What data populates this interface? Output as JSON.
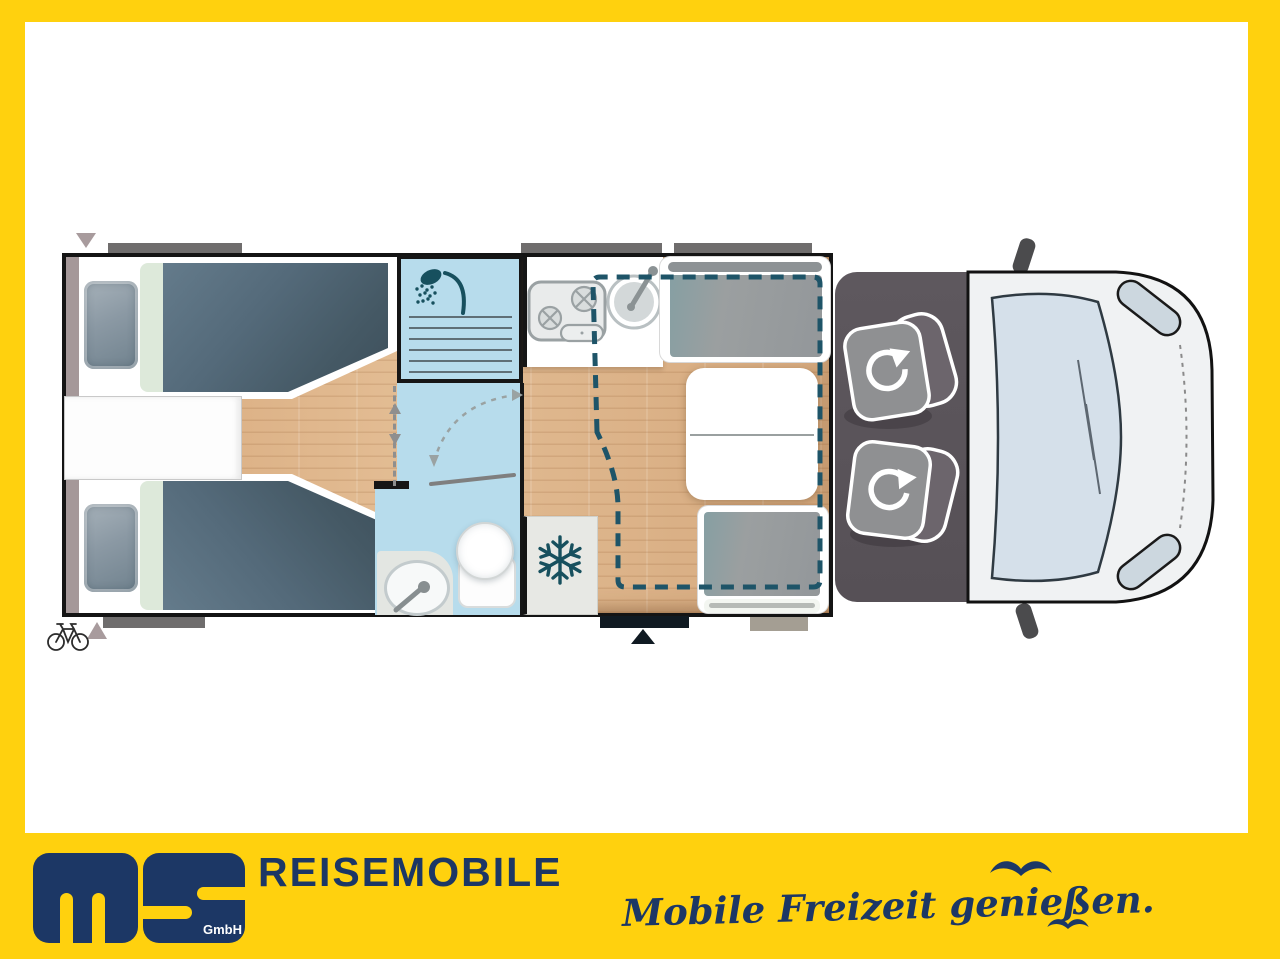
{
  "branding": {
    "logo_text": "ms",
    "logo_suffix": "GmbH",
    "wordmark": "REISEMOBILE",
    "tagline": "Mobile Freizeit genießen."
  },
  "colors": {
    "frame_yellow": "#FFD10E",
    "brand_navy": "#1C3765",
    "floor_wood": "#D9AE83",
    "bathroom_blue": "#B7DCEC",
    "mattress_slate": "#4E6575",
    "cushion_gray": "#9B9FA0",
    "cab_gray": "#5A545A",
    "icon_teal": "#17505E",
    "window_gray": "#6F6D6D"
  },
  "floorplan": {
    "areas": [
      "twin-single-beds",
      "bedside-chest",
      "shower",
      "bathroom",
      "kitchen",
      "fridge",
      "dinette-with-table",
      "drop-down-bed-outline",
      "driver-cab-swivel-seats",
      "vehicle-front"
    ],
    "icons": [
      "shower-icon",
      "snowflake-icon",
      "bicycle-icon",
      "swivel-seat-rotation-icon",
      "door-swing-icon",
      "entrance-arrow-icon",
      "window-marker",
      "seagull-icon"
    ]
  }
}
